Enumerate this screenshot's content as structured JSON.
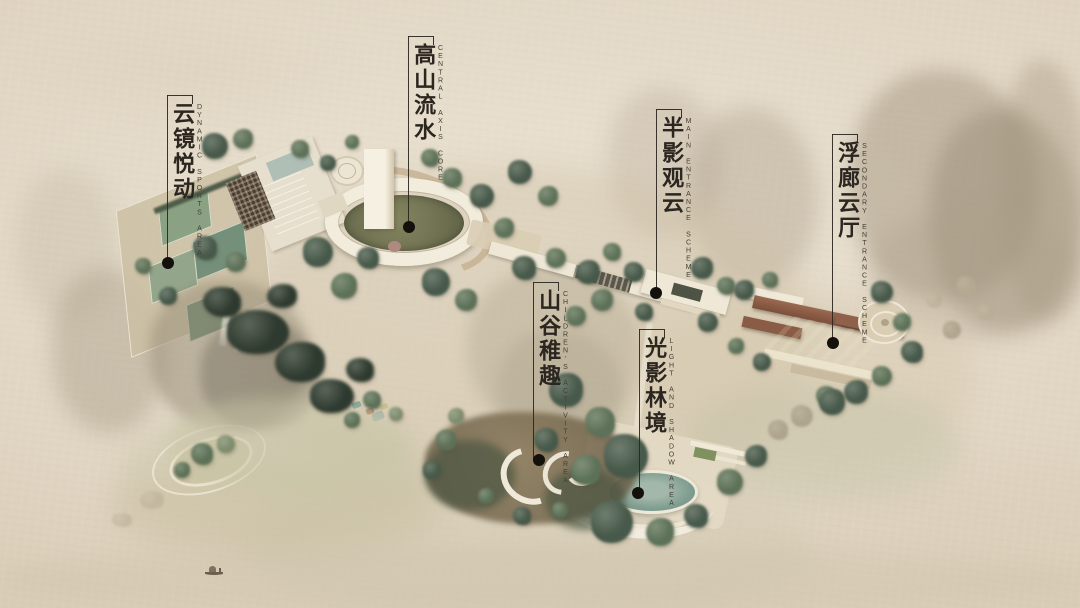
{
  "colors": {
    "paper": "#e0d6c4",
    "ink": "#2b2620",
    "tree_dark": "#2e3a2f",
    "tree_teal": "#47594a",
    "tree_green": "#5d7158",
    "water": "#7e9c90",
    "pool": "#6f9b9b",
    "roof": "#8a5b45",
    "lawn": "#8fa067",
    "path_white": "#f0e9d8"
  },
  "callouts": [
    {
      "zh": "云镜悦动",
      "en": "DYNAMIC SPORTS AREA"
    },
    {
      "zh": "高山流水",
      "en": "CENTRAL AXIS CORE"
    },
    {
      "zh": "半影观云",
      "en": "MAIN ENTRANCE SCHEME"
    },
    {
      "zh": "浮廊云厅",
      "en": "SECONDARY ENTRANCE SCHEME"
    },
    {
      "zh": "山谷稚趣",
      "en": "CHILDREN'S ACTIVITY AREA"
    },
    {
      "zh": "光影林境",
      "en": "LIGHT AND SHADOW AREA"
    }
  ]
}
